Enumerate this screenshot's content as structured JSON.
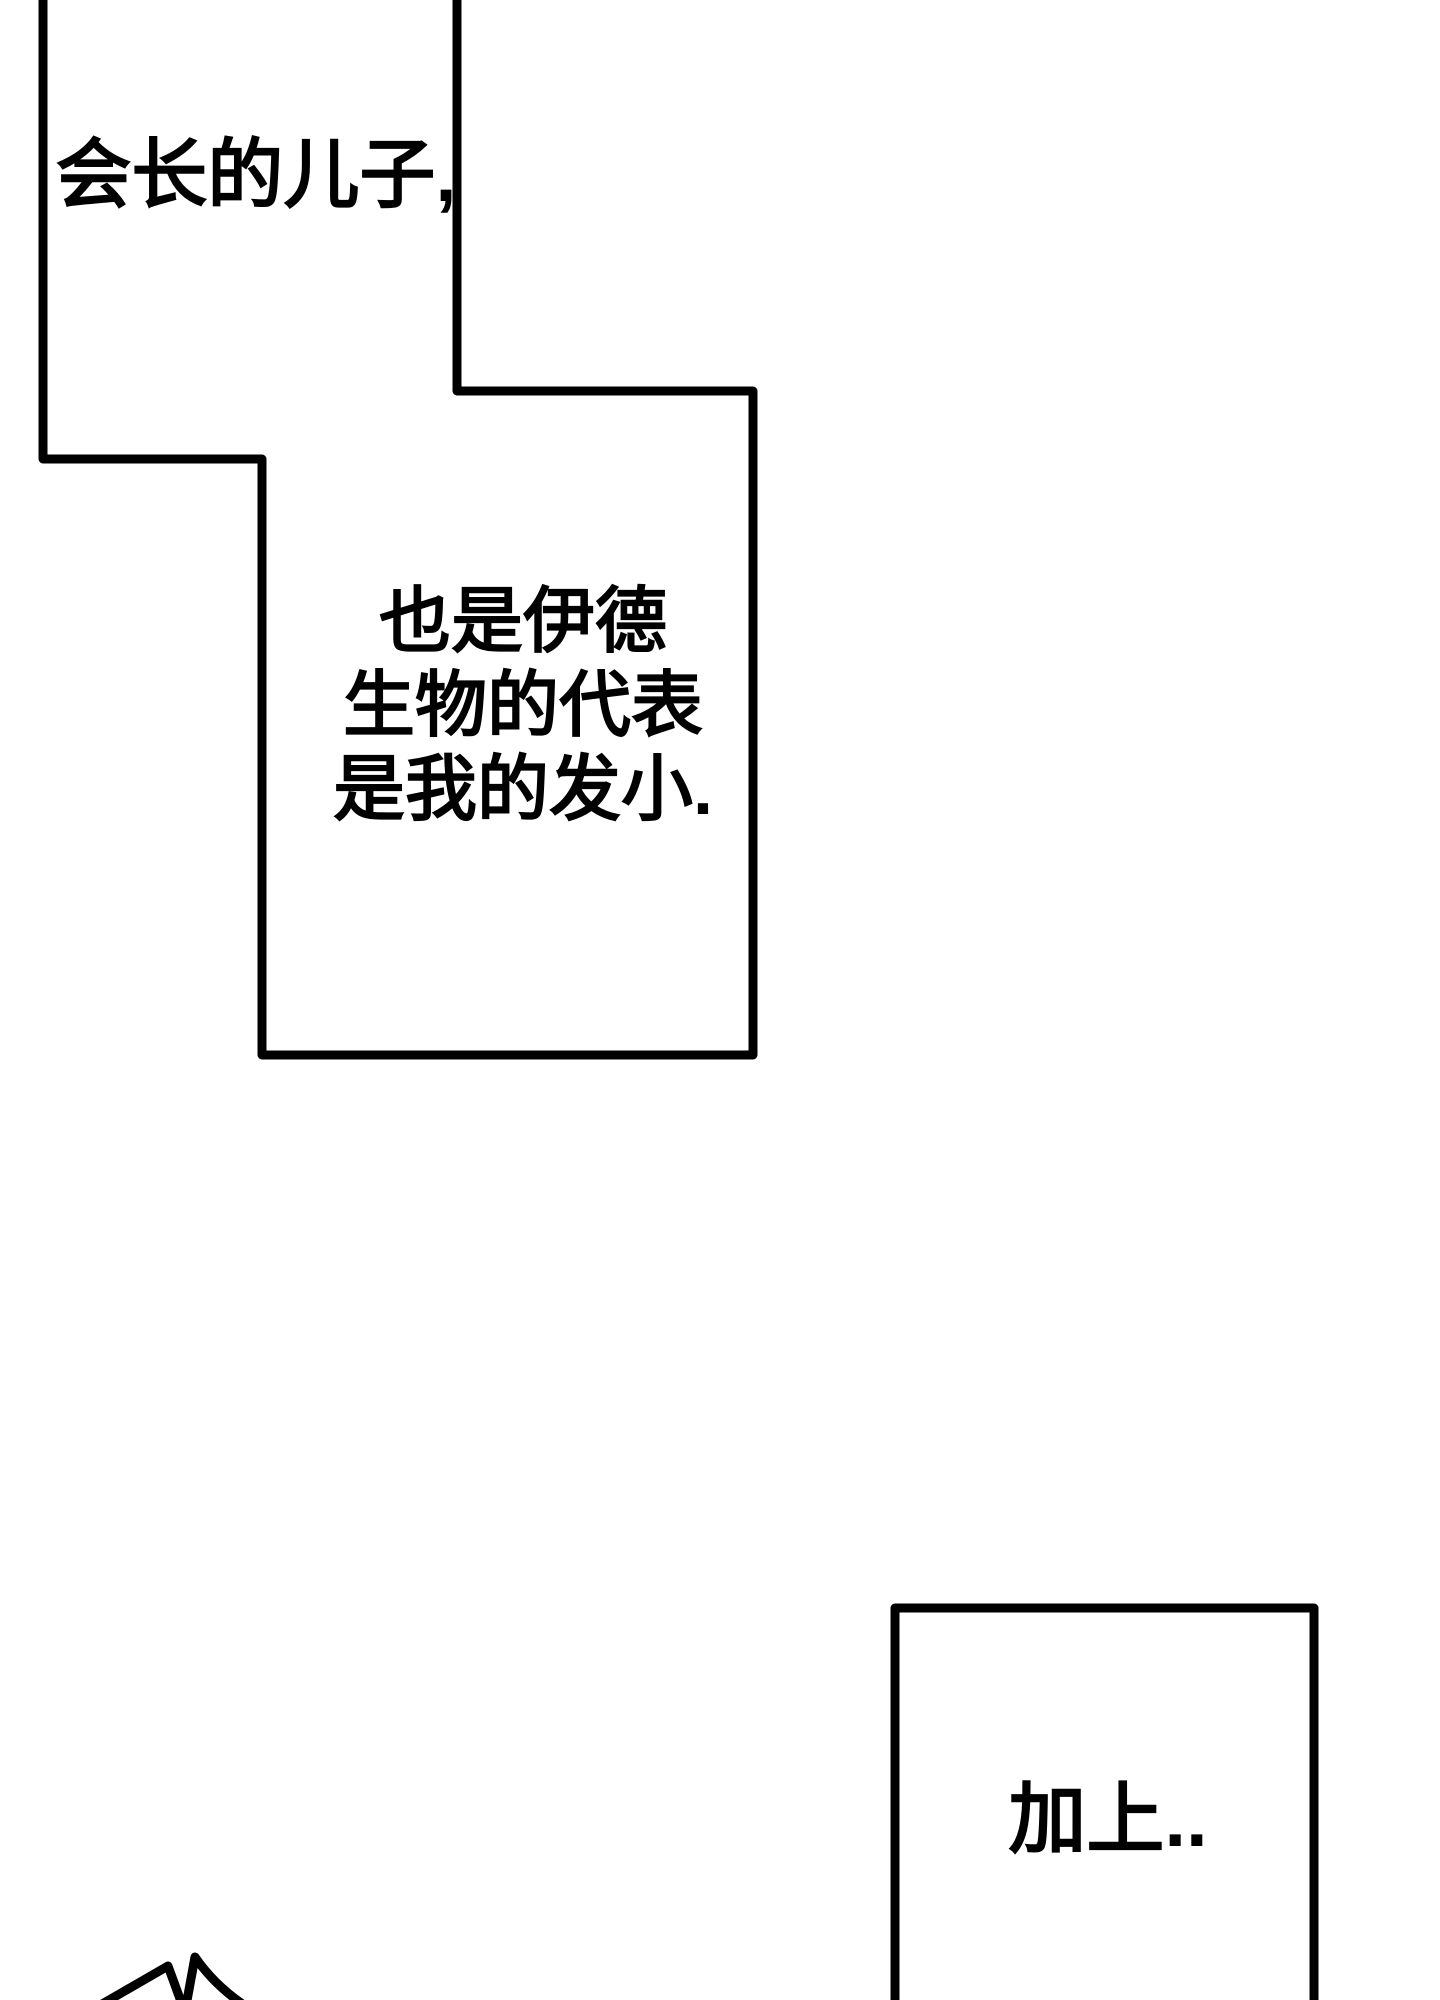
{
  "page": {
    "kind": "comic-page",
    "background_color": "#ffffff",
    "ink_color": "#000000"
  },
  "panels": [
    {
      "name": "top-left-panel",
      "dialogue": "会长的儿子,"
    },
    {
      "name": "middle-stepped-panel",
      "dialogue_lines": [
        "也是伊德",
        "生物的代表",
        "是我的发小."
      ]
    },
    {
      "name": "bottom-right-panel",
      "dialogue": "加上.."
    }
  ],
  "speech_bubble": {
    "name": "bottom-left-bubble",
    "text": ""
  }
}
